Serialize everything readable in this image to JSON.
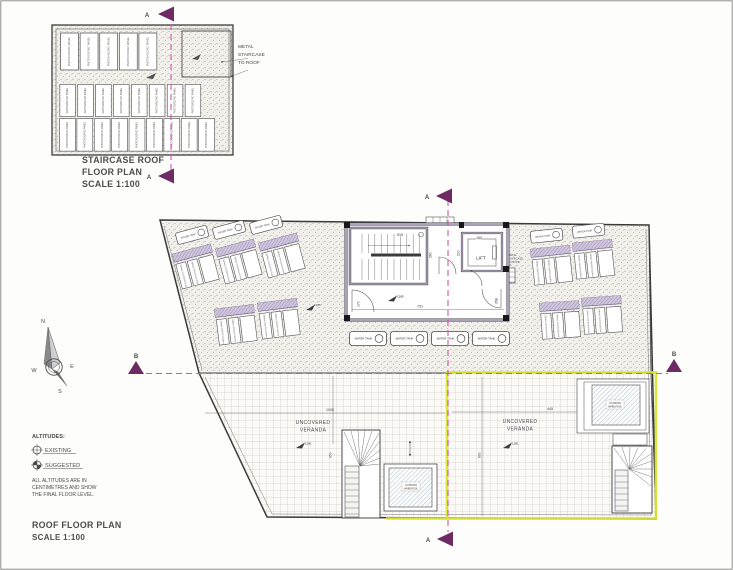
{
  "titles": {
    "staircase_plan": [
      "STAIRCASE ROOF",
      "FLOOR PLAN",
      "SCALE 1:100"
    ],
    "roof_plan": [
      "ROOF FLOOR PLAN",
      "SCALE 1:100"
    ]
  },
  "labels": {
    "pv_panel": "PHOTOVOLTAIC PANEL",
    "water_tank": "WATER TANK",
    "lift": "LIFT",
    "veranda": [
      "UNCOVERED",
      "VERANDA"
    ],
    "whirlpool": [
      "OUTDOOR",
      "WHIRLPOOL"
    ],
    "metal_staircase": [
      "METAL",
      "STAIRCASE",
      "TO ROOF"
    ]
  },
  "dims": {
    "stair_width": "519",
    "stair_depth": "260",
    "lift_width": "160",
    "lift_depth": "200",
    "hall_width": "731",
    "door_left": "170",
    "door_right": "358",
    "veranda_left_width": "1005",
    "veranda_left_depth": "650",
    "veranda_right_width": "445",
    "veranda_right_depth": "690"
  },
  "altitudes": {
    "hall": "1285",
    "terrace": "1285",
    "veranda_left": "1281",
    "veranda_right": "1281"
  },
  "sections": {
    "a": "A",
    "b": "B"
  },
  "compass": {
    "n": "N",
    "e": "E",
    "s": "S",
    "w": "W"
  },
  "legend": {
    "title": "ALTITUDES:",
    "existing": "EXISTING",
    "suggested": "SUGGESTED",
    "note": [
      "ALL ALTITUDES ARE IN",
      "CENTIMETRES AND SHOW",
      "THE FINAL FLOOR LEVEL."
    ]
  },
  "colors": {
    "section_line": "#cb5aa5",
    "section_marker": "#6e2a63",
    "boundary_highlight": "#d9e42e",
    "wall_fill": "#d6cfe3"
  }
}
